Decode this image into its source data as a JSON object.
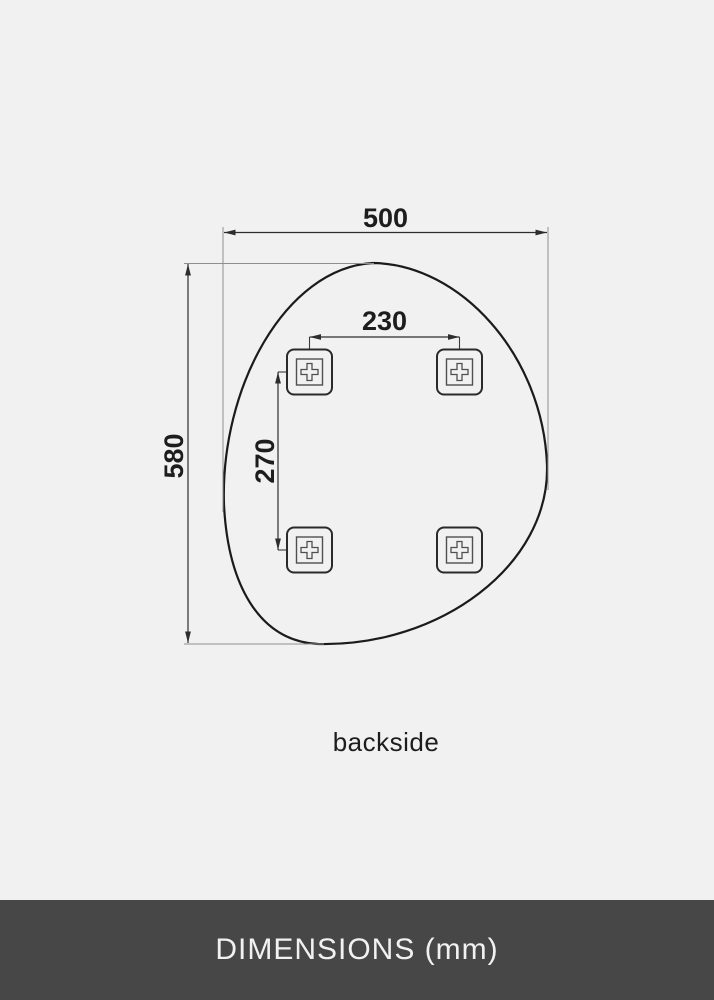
{
  "drawing": {
    "caption": "backside",
    "unit": "mm",
    "dimensions": {
      "overall_width": "500",
      "overall_height": "580",
      "mount_spacing_horizontal": "230",
      "mount_spacing_vertical": "270"
    },
    "mounts": {
      "count": 4,
      "shape": "square-bracket-with-cross"
    }
  },
  "footer": {
    "label": "DIMENSIONS (mm)"
  },
  "colors": {
    "background": "#f1f1f2",
    "outline": "#1b1b1b",
    "dimension_line": "#2d2d2d",
    "extension_line": "#8f8f8f",
    "label_text": "#1d1d1d",
    "footer_background": "#474748",
    "footer_text": "#f1f1f1"
  }
}
